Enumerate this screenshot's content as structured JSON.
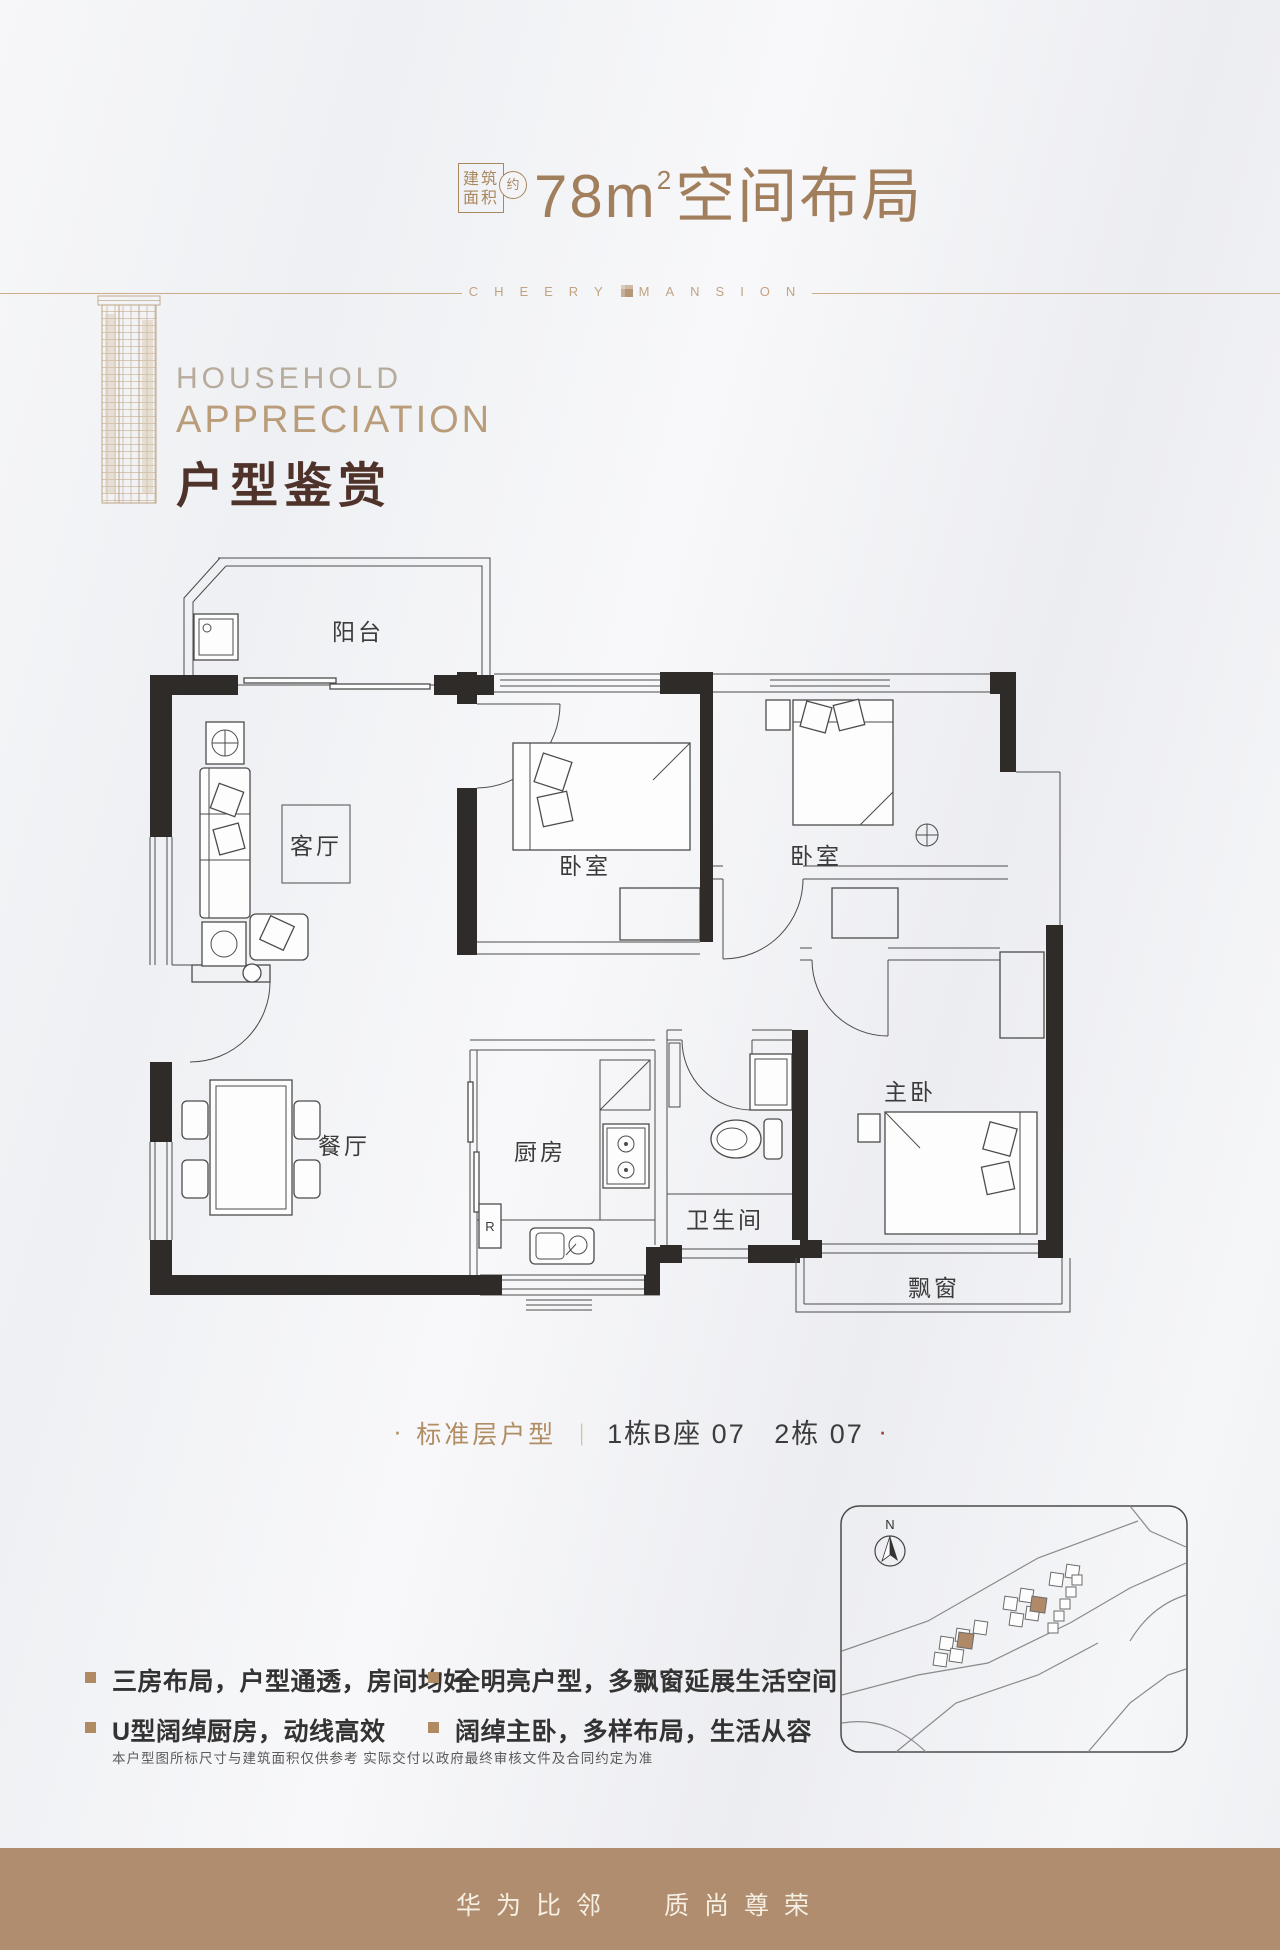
{
  "header": {
    "area_box_line1": "建筑",
    "area_box_line2": "面积",
    "approx": "约",
    "area_value": "78m",
    "area_sup": "2",
    "title_suffix": "空间布局",
    "brand_left": "CHEERY",
    "brand_right": "MANSION"
  },
  "section": {
    "eyebrow": "HOUSEHOLD",
    "title_en": "APPRECIATION",
    "title_cn": "户型鉴赏"
  },
  "plan": {
    "rooms": {
      "balcony": "阳台",
      "living": "客厅",
      "bedroom1": "卧室",
      "bedroom2": "卧室",
      "dining": "餐厅",
      "kitchen": "厨房",
      "bath": "卫生间",
      "master": "主卧",
      "bay": "飘窗"
    },
    "fridge": "R"
  },
  "caption": {
    "lead_dot": "·",
    "label": "标准层户型",
    "separator": "｜",
    "value": "1栋B座 07   2栋 07",
    "end_dot": "·"
  },
  "map": {
    "north": "N"
  },
  "features": {
    "items": [
      "三房布局，户型通透，房间均好",
      "U型阔绰厨房，动线高效",
      "全明亮户型，多飘窗延展生活空间",
      "阔绰主卧，多样布局，生活从容"
    ]
  },
  "disclaimer": "本户型图所标尺寸与建筑面积仅供参考  实际交付以政府最终审核文件及合同约定为准",
  "footer": {
    "slogan_left": "华为比邻",
    "slogan_right": "质尚尊荣"
  },
  "colors": {
    "accent_bronze": "#a27f5c",
    "heading_brown": "#4f332b",
    "bullet_tan": "#b08a63",
    "footer_bg": "#af8d6e",
    "caption_red_dot": "#a03a28",
    "wall_dark": "#2f2b29",
    "map_highlight": "#b08968"
  }
}
